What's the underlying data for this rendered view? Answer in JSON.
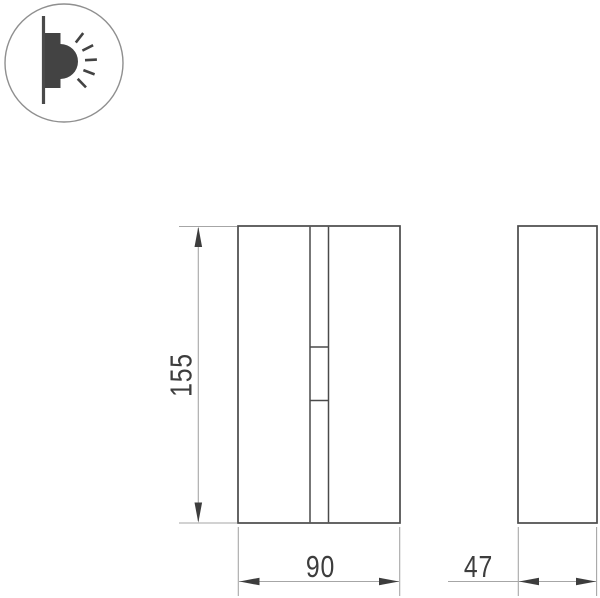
{
  "diagram": {
    "kind": "technical-drawing",
    "product": "surface-mounted wall light",
    "icon": {
      "name": "wall-light-side-emission-icon"
    },
    "dimensions": {
      "height_mm": "155",
      "front_width_mm": "90",
      "side_depth_mm": "47"
    },
    "colors": {
      "background": "#ffffff",
      "object_outline": "#4a4a4a",
      "dimension_lines": "#a6a6a6",
      "dimension_text": "#3d3d3d",
      "icon_fill": "#434343",
      "icon_circle_stroke": "#8f8f8f"
    }
  }
}
